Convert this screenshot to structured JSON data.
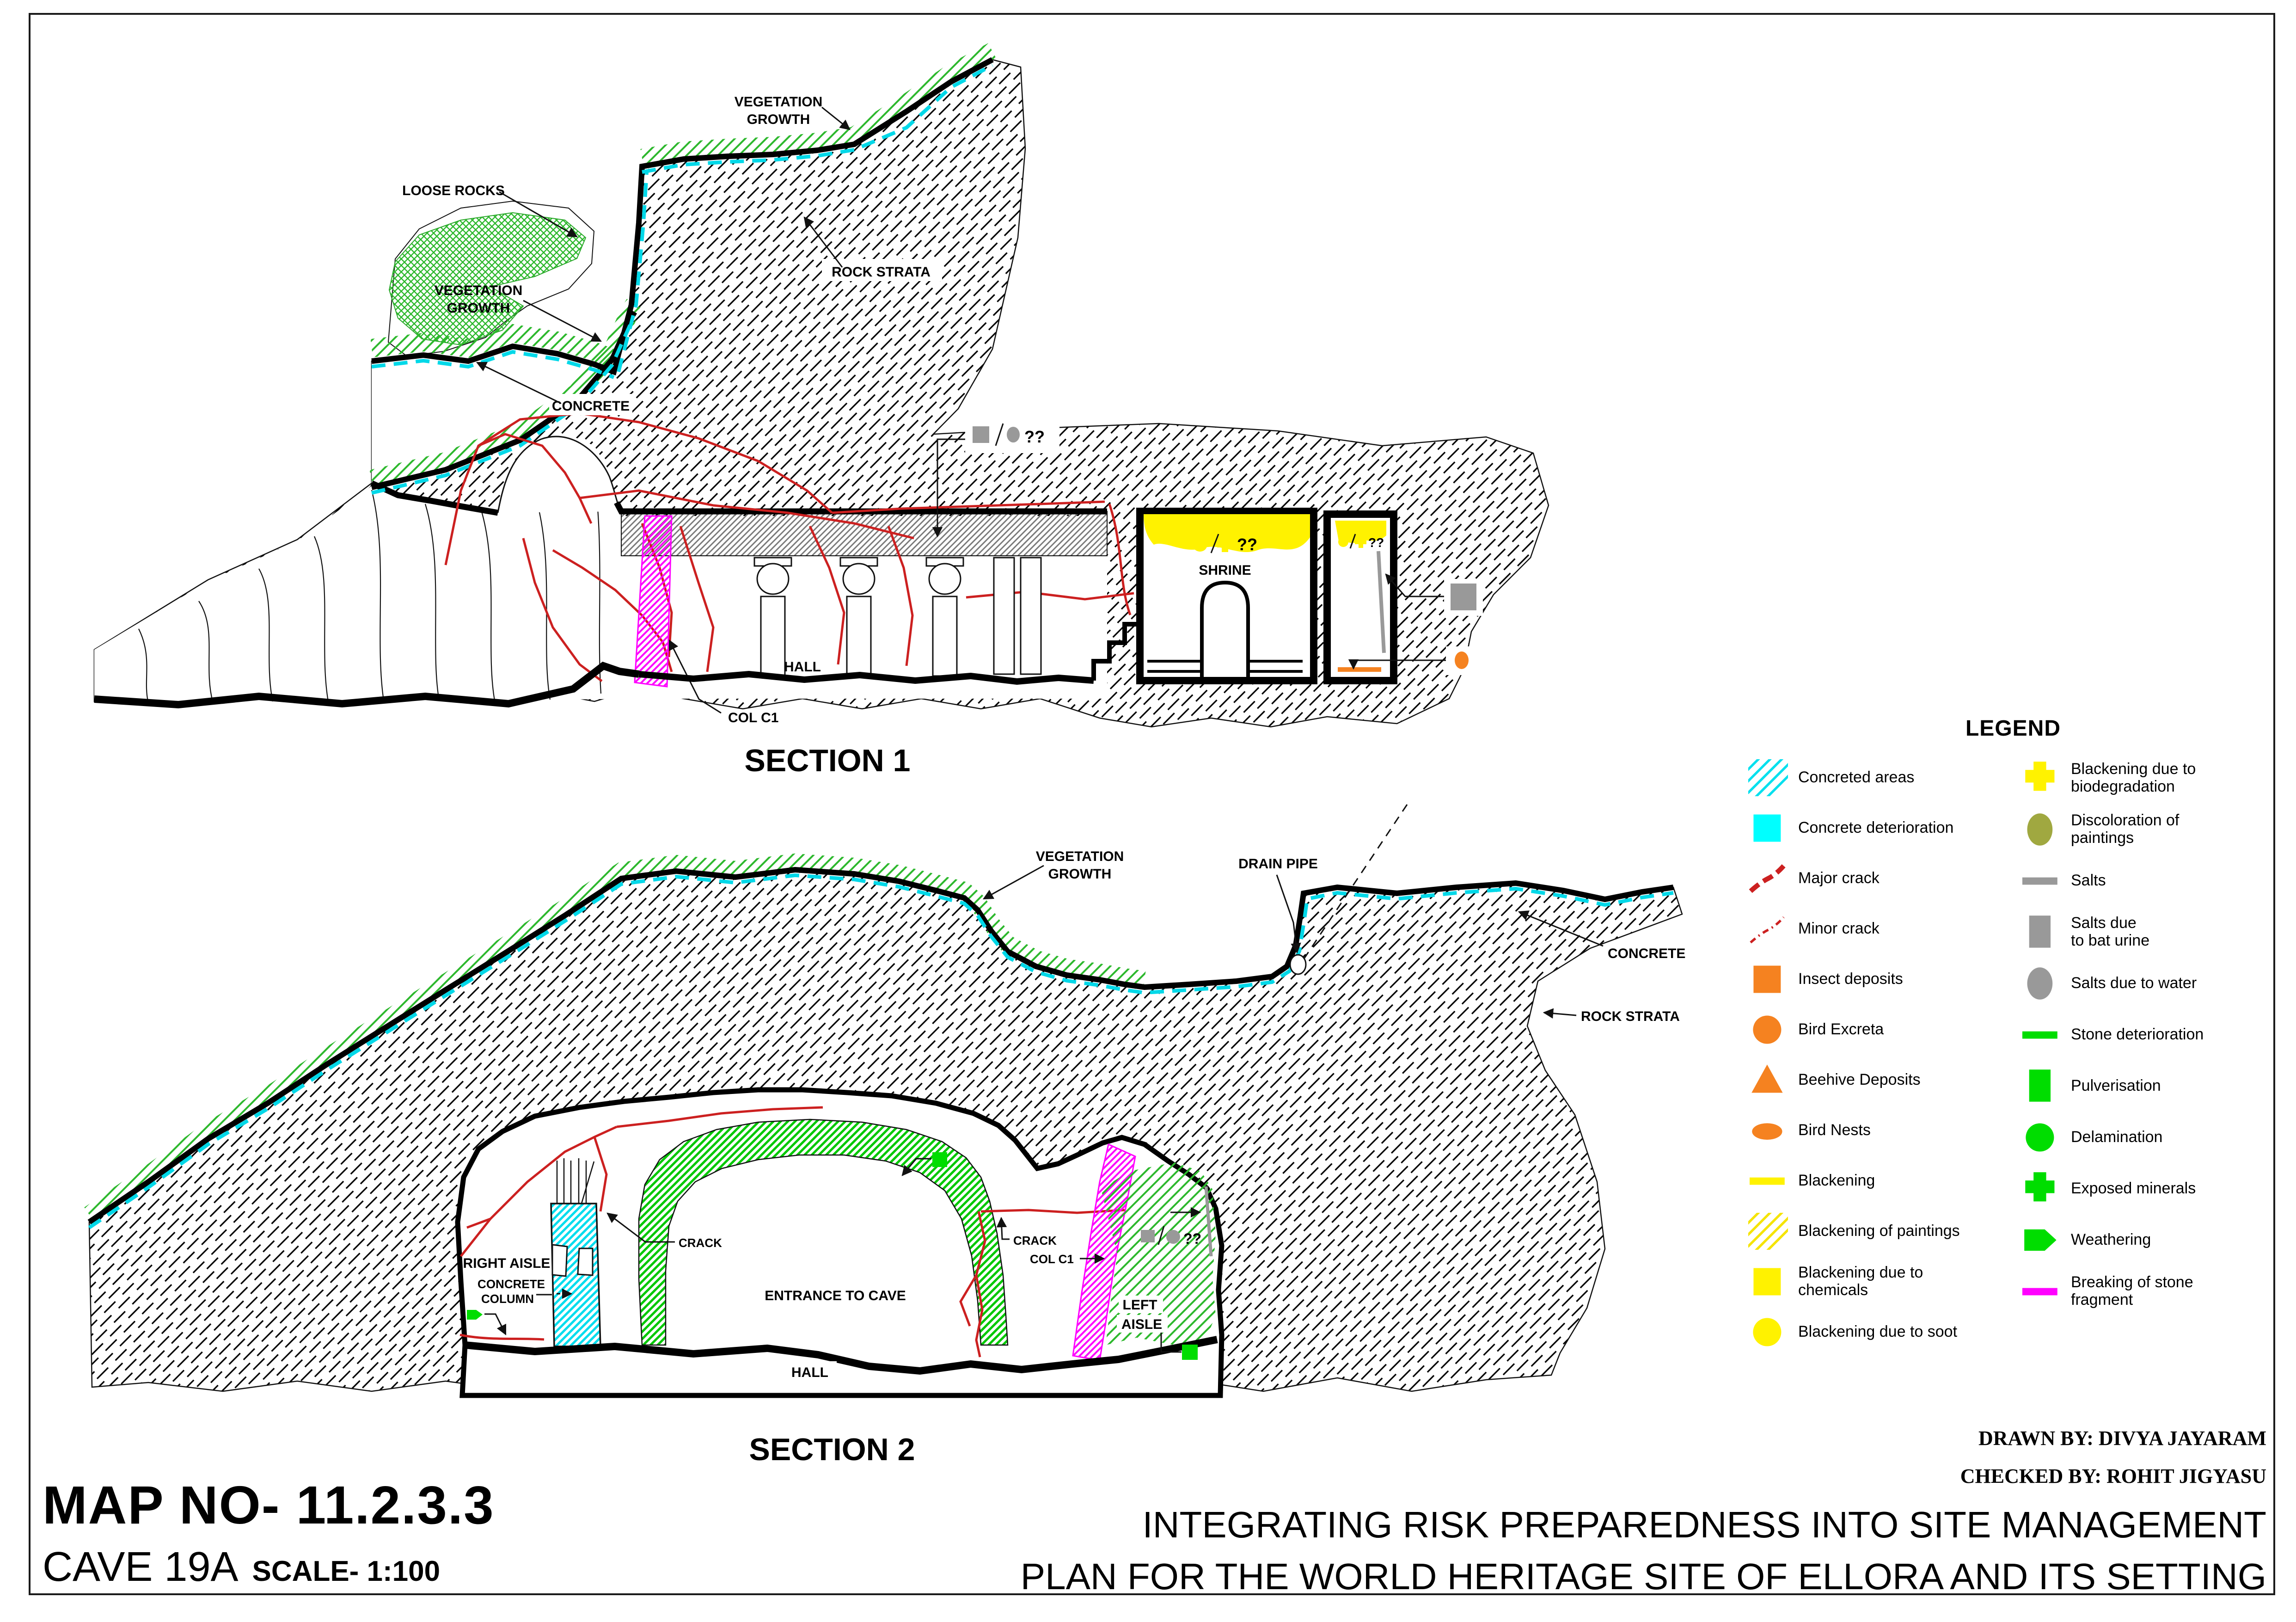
{
  "section1": {
    "title": "SECTION 1",
    "vegetation_growth_top": [
      "VEGETATION",
      "GROWTH"
    ],
    "loose_rocks": "LOOSE ROCKS",
    "vegetation_growth_lower": [
      "VEGETATION",
      "GROWTH"
    ],
    "rock_strata": "ROCK STRATA",
    "concrete": "CONCRETE",
    "hall": "HALL",
    "col_c1": "COL C1",
    "shrine": "SHRINE",
    "q_ceiling": "??",
    "q_shrine": "??",
    "q_chamber": "??"
  },
  "section2": {
    "title": "SECTION 2",
    "vegetation_growth": [
      "VEGETATION",
      "GROWTH"
    ],
    "drain_pipe": "DRAIN PIPE",
    "concrete": "CONCRETE",
    "rock_strata": "ROCK STRATA",
    "right_aisle": "RIGHT AISLE",
    "concrete_column": [
      "CONCRETE",
      "COLUMN"
    ],
    "entrance": "ENTRANCE TO CAVE",
    "crack1": "CRACK",
    "crack2": "CRACK",
    "col_c1": "COL C1",
    "left_aisle": [
      "LEFT",
      "AISLE"
    ],
    "q_aisle": "??",
    "hall": "HALL"
  },
  "legend": {
    "title": "LEGEND",
    "left": [
      {
        "label": "Concreted areas",
        "shape": "hatch",
        "color": "#00E0EE"
      },
      {
        "label": "Concrete deterioration",
        "shape": "square",
        "color": "#00FFFF"
      },
      {
        "label": "Major crack",
        "shape": "dash-curve",
        "color": "#CC2020"
      },
      {
        "label": "Minor crack",
        "shape": "dashdot-curve",
        "color": "#CC2020"
      },
      {
        "label": "Insect deposits",
        "shape": "square",
        "color": "#F58220"
      },
      {
        "label": "Bird Excreta",
        "shape": "circle",
        "color": "#F58220"
      },
      {
        "label": "Beehive Deposits",
        "shape": "triangle",
        "color": "#F58220"
      },
      {
        "label": "Bird Nests",
        "shape": "ellipse",
        "color": "#F58220"
      },
      {
        "label": "Blackening",
        "shape": "line",
        "color": "#FFF200"
      },
      {
        "label": "Blackening of paintings",
        "shape": "hatch",
        "color": "#F5E400"
      },
      {
        "label": "Blackening due to\nchemicals",
        "shape": "square",
        "color": "#FFF200"
      },
      {
        "label": "Blackening due to soot",
        "shape": "circle",
        "color": "#FFF200"
      }
    ],
    "right": [
      {
        "label": "Blackening due to\nbiodegradation",
        "shape": "plus",
        "color": "#FFF200"
      },
      {
        "label": "Discoloration of\npaintings",
        "shape": "ellipse-tall",
        "color": "#A0A840"
      },
      {
        "label": "Salts",
        "shape": "line",
        "color": "#999999"
      },
      {
        "label": "Salts due\nto bat urine",
        "shape": "rect-tall",
        "color": "#999999"
      },
      {
        "label": "Salts due to water",
        "shape": "ellipse-tall",
        "color": "#999999"
      },
      {
        "label": "Stone deterioration",
        "shape": "line",
        "color": "#00DD00"
      },
      {
        "label": "Pulverisation",
        "shape": "rect-tall",
        "color": "#00DD00"
      },
      {
        "label": "Delamination",
        "shape": "circle",
        "color": "#00DD00"
      },
      {
        "label": "Exposed minerals",
        "shape": "plus",
        "color": "#00DD00"
      },
      {
        "label": "Weathering",
        "shape": "pentagon",
        "color": "#00DD00"
      },
      {
        "label": "Breaking of stone\nfragment",
        "shape": "line",
        "color": "#FF00FF"
      }
    ]
  },
  "titleblock": {
    "drawn_by": "DRAWN BY: DIVYA JAYARAM",
    "checked_by": "CHECKED BY: ROHIT JIGYASU",
    "map_no": "MAP NO- 11.2.3.3",
    "cave": "CAVE 19A",
    "scale": "SCALE- 1:100",
    "main_title_line1": "INTEGRATING RISK PREPAREDNESS INTO SITE MANAGEMENT",
    "main_title_line2": "PLAN FOR THE WORLD HERITAGE SITE OF ELLORA AND ITS SETTING"
  },
  "colors": {
    "rock_outline": "#000000",
    "concrete_line": "#00D8E8",
    "vegetation": "#2DB82D",
    "crack": "#CC2020",
    "blackening": "#FFF200",
    "salts": "#999999",
    "deterioration_green": "#00DD00",
    "breaking_magenta": "#FF00FF",
    "bird_orange": "#F58220",
    "discoloration_olive": "#A0A840"
  }
}
